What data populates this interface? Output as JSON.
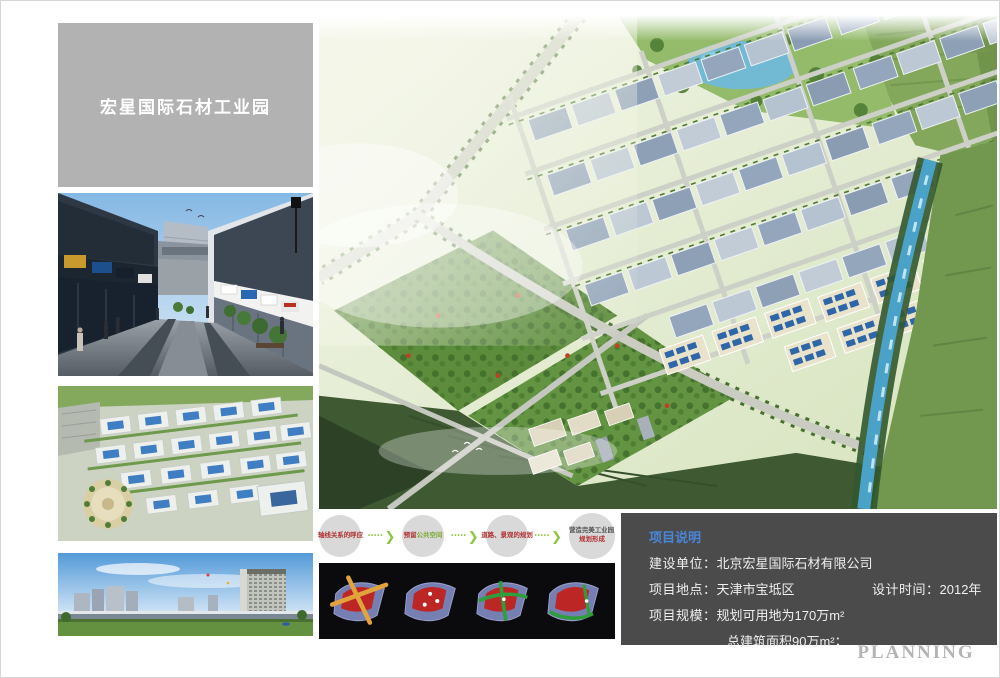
{
  "title_box": {
    "title": "宏星国际石材工业园"
  },
  "flow": {
    "arrow_dots": "•••••",
    "arrow_chevron": "❯",
    "steps": [
      {
        "label": "轴线关系的呼应"
      },
      {
        "label": "预留",
        "label2": "公共空间"
      },
      {
        "label": "道路、景观的规划"
      },
      {
        "label": "营造完美工业园",
        "sub": "规划形成"
      }
    ]
  },
  "info_box": {
    "heading": "项目说明",
    "rows": [
      {
        "label": "建设单位：",
        "value": "北京宏星国际石材有限公司"
      },
      {
        "label": "项目地点：",
        "value": "天津市宝坻区",
        "label2": "设计时间：",
        "value2": "2012年"
      },
      {
        "label": "项目规模：",
        "value": "规划可用地为170万m²"
      },
      {
        "label": "",
        "value": "总建筑面积90万m²；"
      }
    ]
  },
  "footer": {
    "planning": "PLANNING"
  },
  "colors": {
    "stripe": "#dbe45f",
    "title_box_bg": "#b2b2b2",
    "info_box_bg": "#4b4b4b",
    "info_heading": "#4a86d8",
    "flow_arrow_green": "#8dc63f",
    "flow_text_red": "#b03030"
  }
}
